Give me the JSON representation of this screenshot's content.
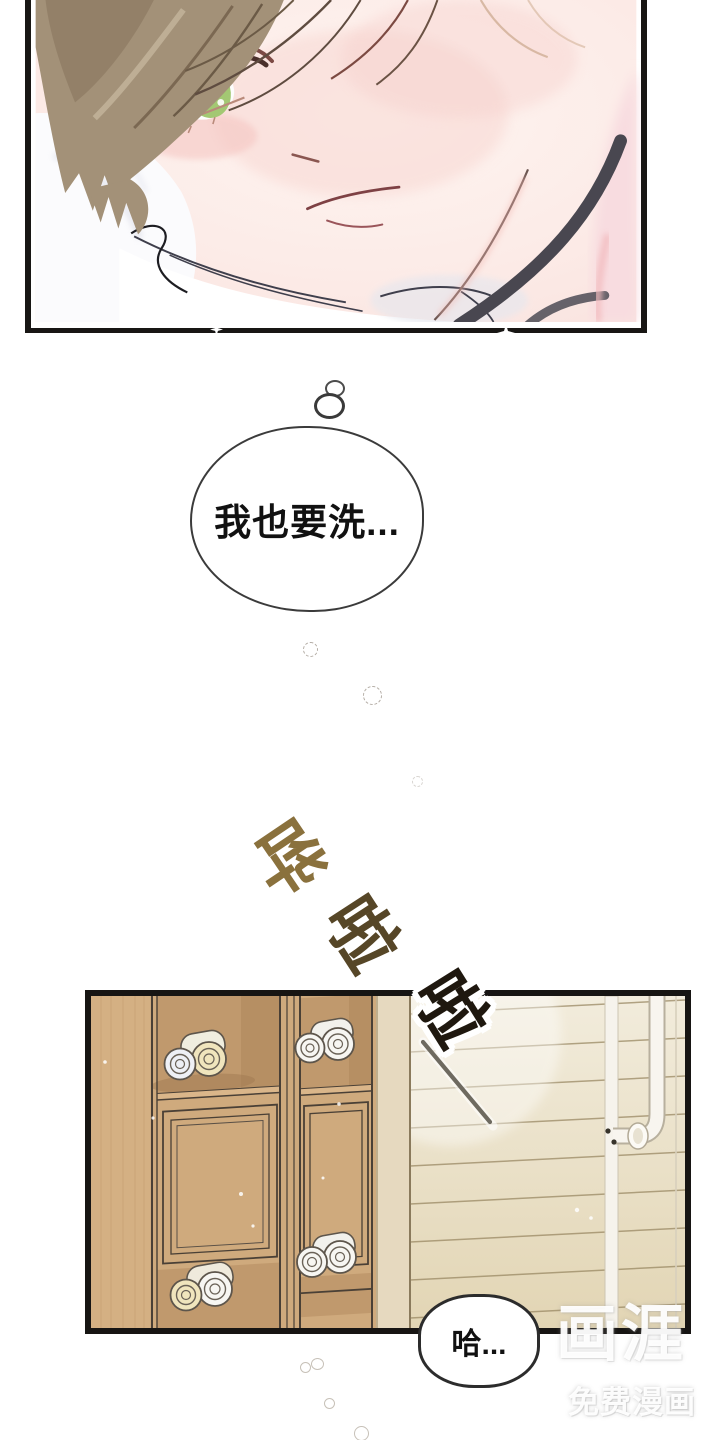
{
  "page": {
    "type": "webtoon-comic-page",
    "background": "#ffffff"
  },
  "panels": [
    {
      "id": "closeup",
      "description": "close-up of a blushing young man with brown hair and green eyes lying on a white pillow, dark choker strap across his neck"
    },
    {
      "id": "bathhouse",
      "description": "wooden locker cubbies holding rolled towels next to a slatted sauna wall with a shower pipe and faucet"
    }
  ],
  "bubbles": {
    "thought": {
      "text": "我也要洗..."
    },
    "gasp": {
      "text": "哈..."
    }
  },
  "sfx": {
    "text": "哗啦啦",
    "chars": [
      "哗",
      "啦",
      "啦"
    ],
    "colors": [
      "#8a713d",
      "#564627",
      "#1f180f"
    ],
    "meaning": "water splashing sound effect"
  },
  "watermark": {
    "logo": "画涯",
    "tagline": "免费漫画",
    "color": "#ffffff"
  },
  "colors": {
    "panel_border": "#171513",
    "skin": "#fdefe9",
    "blush": "#f6cdc9",
    "hair": "#a29077",
    "eye_green": "#9fc66f",
    "choker": "#494750",
    "wood": "#cfaa7d",
    "wood_wall_light": "#eee7d2",
    "towel_white": "#f7f6f2",
    "towel_cream": "#f0e5bd"
  }
}
